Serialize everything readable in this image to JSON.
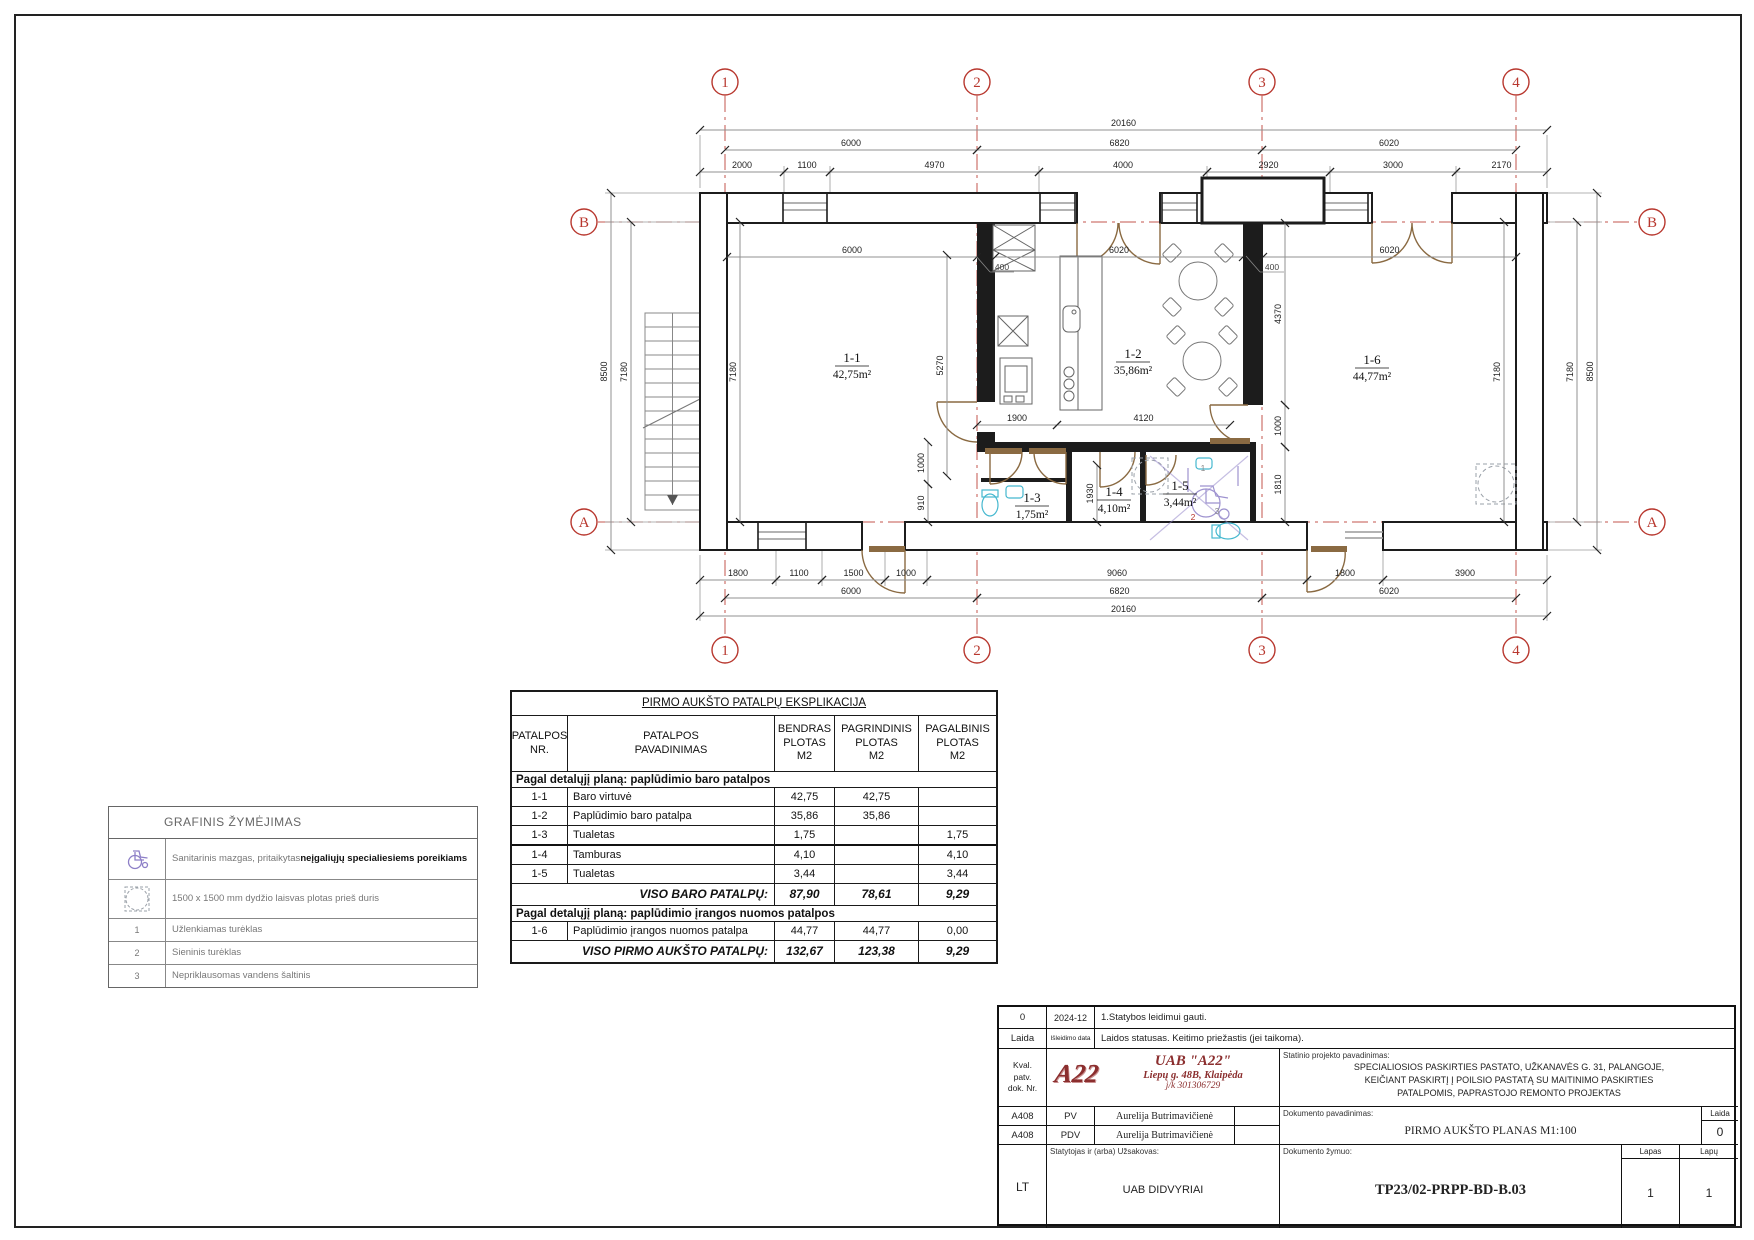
{
  "colors": {
    "accent_red": "#b8372e",
    "wall": "#1c1c1c",
    "door_brown": "#8a6a42",
    "fixture_cyan": "#45b8cf",
    "access_purple": "#8d7fc7",
    "logo_red": "#8b2e2e"
  },
  "plan": {
    "grid_cols": [
      {
        "label": "1",
        "x": 725
      },
      {
        "label": "2",
        "x": 977
      },
      {
        "label": "3",
        "x": 1262
      },
      {
        "label": "4",
        "x": 1516
      }
    ],
    "grid_rows": [
      {
        "label": "B",
        "y": 222
      },
      {
        "label": "A",
        "y": 522
      }
    ],
    "dims": [
      {
        "t": "20160",
        "x1": 700,
        "y1": 130,
        "x2": 1547,
        "y2": 130
      },
      {
        "t": "6000",
        "x1": 725,
        "y1": 150,
        "x2": 977,
        "y2": 150
      },
      {
        "t": "6820",
        "x1": 977,
        "y1": 150,
        "x2": 1262,
        "y2": 150
      },
      {
        "t": "6020",
        "x1": 1262,
        "y1": 150,
        "x2": 1516,
        "y2": 150
      },
      {
        "t": "2000",
        "x1": 700,
        "y1": 172,
        "x2": 784,
        "y2": 172
      },
      {
        "t": "1100",
        "x1": 784,
        "y1": 172,
        "x2": 830,
        "y2": 172
      },
      {
        "t": "4970",
        "x1": 830,
        "y1": 172,
        "x2": 1039,
        "y2": 172
      },
      {
        "t": "4000",
        "x1": 1039,
        "y1": 172,
        "x2": 1207,
        "y2": 172
      },
      {
        "t": "2920",
        "x1": 1207,
        "y1": 172,
        "x2": 1330,
        "y2": 172
      },
      {
        "t": "3000",
        "x1": 1330,
        "y1": 172,
        "x2": 1456,
        "y2": 172
      },
      {
        "t": "2170",
        "x1": 1456,
        "y1": 172,
        "x2": 1547,
        "y2": 172
      },
      {
        "t": "1800",
        "x1": 700,
        "y1": 580,
        "x2": 776,
        "y2": 580
      },
      {
        "t": "1100",
        "x1": 776,
        "y1": 580,
        "x2": 822,
        "y2": 580
      },
      {
        "t": "1500",
        "x1": 822,
        "y1": 580,
        "x2": 885,
        "y2": 580
      },
      {
        "t": "1000",
        "x1": 885,
        "y1": 580,
        "x2": 927,
        "y2": 580
      },
      {
        "t": "9060",
        "x1": 927,
        "y1": 580,
        "x2": 1307,
        "y2": 580
      },
      {
        "t": "1800",
        "x1": 1307,
        "y1": 580,
        "x2": 1383,
        "y2": 580
      },
      {
        "t": "3900",
        "x1": 1383,
        "y1": 580,
        "x2": 1547,
        "y2": 580
      },
      {
        "t": "6000",
        "x1": 725,
        "y1": 598,
        "x2": 977,
        "y2": 598
      },
      {
        "t": "6820",
        "x1": 977,
        "y1": 598,
        "x2": 1262,
        "y2": 598
      },
      {
        "t": "6020",
        "x1": 1262,
        "y1": 598,
        "x2": 1516,
        "y2": 598
      },
      {
        "t": "20160",
        "x1": 700,
        "y1": 616,
        "x2": 1547,
        "y2": 616
      },
      {
        "t": "8500",
        "x1": 611,
        "y1": 193,
        "x2": 611,
        "y2": 550
      },
      {
        "t": "7180",
        "x1": 631,
        "y1": 222,
        "x2": 631,
        "y2": 522
      },
      {
        "t": "7180",
        "x1": 1577,
        "y1": 222,
        "x2": 1577,
        "y2": 522
      },
      {
        "t": "8500",
        "x1": 1597,
        "y1": 193,
        "x2": 1597,
        "y2": 550
      },
      {
        "t": "6000",
        "x1": 727,
        "y1": 257,
        "x2": 977,
        "y2": 257
      },
      {
        "t": "6020",
        "x1": 995,
        "y1": 257,
        "x2": 1243,
        "y2": 257
      },
      {
        "t": "6020",
        "x1": 1263,
        "y1": 257,
        "x2": 1516,
        "y2": 257
      },
      {
        "t": "7180",
        "x1": 740,
        "y1": 222,
        "x2": 740,
        "y2": 522
      },
      {
        "t": "7180",
        "x1": 1504,
        "y1": 222,
        "x2": 1504,
        "y2": 522
      },
      {
        "t": "5270",
        "x1": 947,
        "y1": 255,
        "x2": 947,
        "y2": 476
      },
      {
        "t": "4370",
        "x1": 1285,
        "y1": 223,
        "x2": 1285,
        "y2": 405
      },
      {
        "t": "1000",
        "x1": 1285,
        "y1": 405,
        "x2": 1285,
        "y2": 447
      },
      {
        "t": "1810",
        "x1": 1285,
        "y1": 447,
        "x2": 1285,
        "y2": 522
      },
      {
        "t": "1900",
        "x1": 977,
        "y1": 425,
        "x2": 1057,
        "y2": 425
      },
      {
        "t": "4120",
        "x1": 1057,
        "y1": 425,
        "x2": 1230,
        "y2": 425
      },
      {
        "t": "1000",
        "x1": 928,
        "y1": 442,
        "x2": 928,
        "y2": 484
      },
      {
        "t": "910",
        "x1": 928,
        "y1": 484,
        "x2": 928,
        "y2": 522
      },
      {
        "t": "1930",
        "x1": 1097,
        "y1": 465,
        "x2": 1097,
        "y2": 522
      }
    ],
    "rooms": [
      {
        "id": "1-1",
        "area": "42,75m²",
        "x": 852,
        "y": 362
      },
      {
        "id": "1-2",
        "area": "35,86m²",
        "x": 1133,
        "y": 358
      },
      {
        "id": "1-6",
        "area": "44,77m²",
        "x": 1372,
        "y": 364
      },
      {
        "id": "1-3",
        "area": "1,75m²",
        "x": 1032,
        "y": 502
      },
      {
        "id": "1-4",
        "area": "4,10m²",
        "x": 1114,
        "y": 496
      },
      {
        "id": "1-5",
        "area": "3,44m²",
        "x": 1180,
        "y": 490
      }
    ],
    "notes": [
      {
        "t": "400",
        "x": 1002,
        "y": 270,
        "c": "#444",
        "u": true
      },
      {
        "t": "400",
        "x": 1272,
        "y": 270,
        "c": "#444",
        "u": true
      },
      {
        "t": "1",
        "x": 1203,
        "y": 471,
        "c": "#888"
      },
      {
        "t": "2",
        "x": 1193,
        "y": 520,
        "c": "#b8372e"
      },
      {
        "t": "3",
        "x": 1217,
        "y": 514,
        "c": "#888"
      }
    ]
  },
  "explication": {
    "title": "PIRMO AUKŠTO PATALPŲ EKSPLIKACIJA",
    "headers": [
      "PATALPOS\nNR.",
      "PATALPOS\nPAVADINIMAS",
      "BENDRAS\nPLOTAS\nM2",
      "PAGRINDINIS\nPLOTAS\nM2",
      "PAGALBINIS\nPLOTAS\nM2"
    ],
    "sections": [
      {
        "heading": "Pagal detalųjį planą: paplūdimio baro patalpos",
        "rows": [
          [
            "1-1",
            "Baro virtuvė",
            "42,75",
            "42,75",
            ""
          ],
          [
            "1-2",
            "Paplūdimio baro patalpa",
            "35,86",
            "35,86",
            ""
          ],
          [
            "1-3",
            "Tualetas",
            "1,75",
            "",
            "1,75"
          ],
          [
            "1-4",
            "Tamburas",
            "4,10",
            "",
            "4,10"
          ],
          [
            "1-5",
            "Tualetas",
            "3,44",
            "",
            "3,44"
          ]
        ],
        "total": {
          "label": "VISO BARO PATALPŲ:",
          "values": [
            "87,90",
            "78,61",
            "9,29"
          ]
        }
      },
      {
        "heading": "Pagal detalųjį planą: paplūdimio įrangos nuomos patalpos",
        "rows": [
          [
            "1-6",
            "Paplūdimio įrangos nuomos patalpa",
            "44,77",
            "44,77",
            "0,00"
          ]
        ],
        "total": {
          "label": "VISO PIRMO AUKŠTO PATALPŲ:",
          "values": [
            "132,67",
            "123,38",
            "9,29"
          ]
        }
      }
    ]
  },
  "legend": {
    "title": "GRAFINIS ŽYMĖJIMAS",
    "rows": [
      {
        "icon": "wheelchair-icon",
        "text": "Sanitarinis mazgas, pritaikytas ",
        "text_bold": "neįgaliųjų specialiesiems poreikiams"
      },
      {
        "icon": "clearance-icon",
        "text": "1500 x 1500 mm dydžio laisvas plotas prieš duris",
        "text_bold": ""
      },
      {
        "num": "1",
        "text": "Užlenkiamas turėklas"
      },
      {
        "num": "2",
        "text": "Sieninis turėklas"
      },
      {
        "num": "3",
        "text": "Nepriklausomas vandens šaltinis"
      }
    ]
  },
  "titleblock": {
    "rev_no": "0",
    "rev_date": "2024-12",
    "rev_note": "1.Statybos leidimui gauti.",
    "laida_h": "Laida",
    "date_h": "Išleidimo data",
    "status_h": "Laidos statusas. Keitimo priežastis (jei taikoma).",
    "kval": "Kval.\npatv.\ndok. Nr.",
    "logo": "A22",
    "company": "UAB \"A22\"",
    "address": "Liepų g. 48B, Klaipėda",
    "company_code": "j/k 301306729",
    "project_label": "Statinio projekto pavadinimas:",
    "project_name": "SPECIALIOSIOS PASKIRTIES PASTATO, UŽKANAVĖS G. 31, PALANGOJE,\nKEIČIANT PASKIRTĮ Į POILSIO PASTATĄ SU MAITINIMO PASKIRTIES\nPATALPOMIS, PAPRASTOJO REMONTO PROJEKTAS",
    "rows": [
      {
        "cert": "A408",
        "role": "PV",
        "name": "Aurelija Butrimavičienė"
      },
      {
        "cert": "A408",
        "role": "PDV",
        "name": "Aurelija Butrimavičienė"
      }
    ],
    "doc_label": "Dokumento pavadinimas:",
    "doc_name": "PIRMO AUKŠTO PLANAS M1:100",
    "laida_label": "Laida",
    "laida_value": "0",
    "lang": "LT",
    "client_label": "Statytojas ir (arba) Užsakovas:",
    "client": "UAB DIDVYRIAI",
    "code_label": "Dokumento žymuo:",
    "code": "TP23/02-PRPP-BD-B.03",
    "lapas_label": "Lapas",
    "lapas": "1",
    "lapu_label": "Lapų",
    "lapu": "1"
  }
}
